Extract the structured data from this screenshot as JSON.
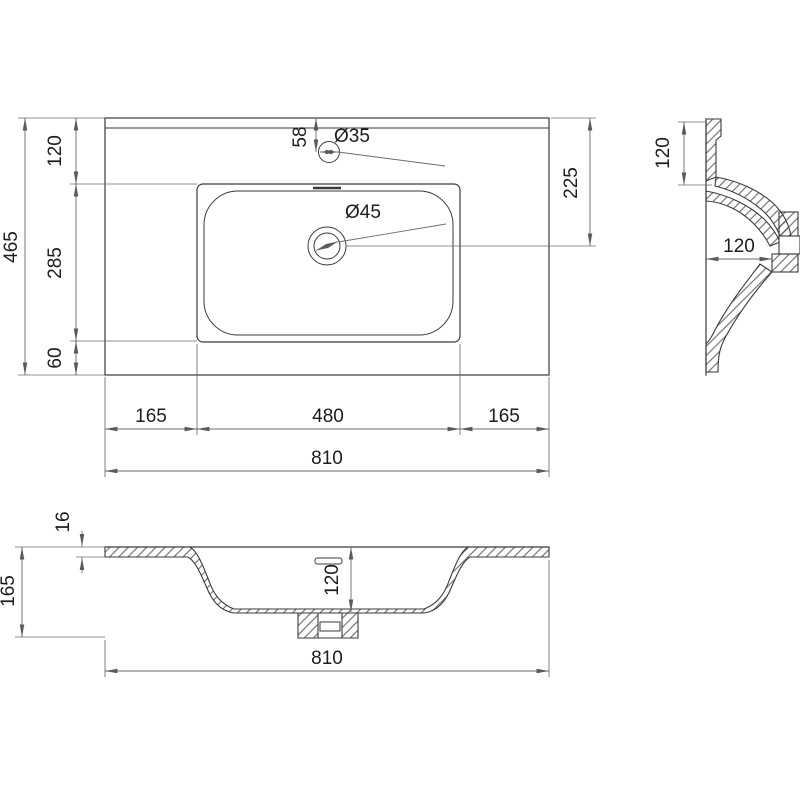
{
  "colors": {
    "background": "#ffffff",
    "line": "#3a3a3a",
    "dim": "#6b6b6b",
    "text": "#1c1c1c"
  },
  "dims": {
    "plan": {
      "overall_depth": "465",
      "back_ledge": "120",
      "basin_depth": "285",
      "front_ledge": "60",
      "faucet_offset": "58",
      "faucet_hole": "Ø35",
      "drain_hole": "Ø45",
      "drain_from_back": "225",
      "left_ledge": "165",
      "basin_width": "480",
      "right_ledge": "165",
      "overall_width": "810"
    },
    "side": {
      "back_ledge": "120",
      "bowl_depth": "120"
    },
    "front": {
      "rim_thickness": "16",
      "overall_height": "165",
      "bowl_depth": "120",
      "overall_width": "810"
    }
  }
}
